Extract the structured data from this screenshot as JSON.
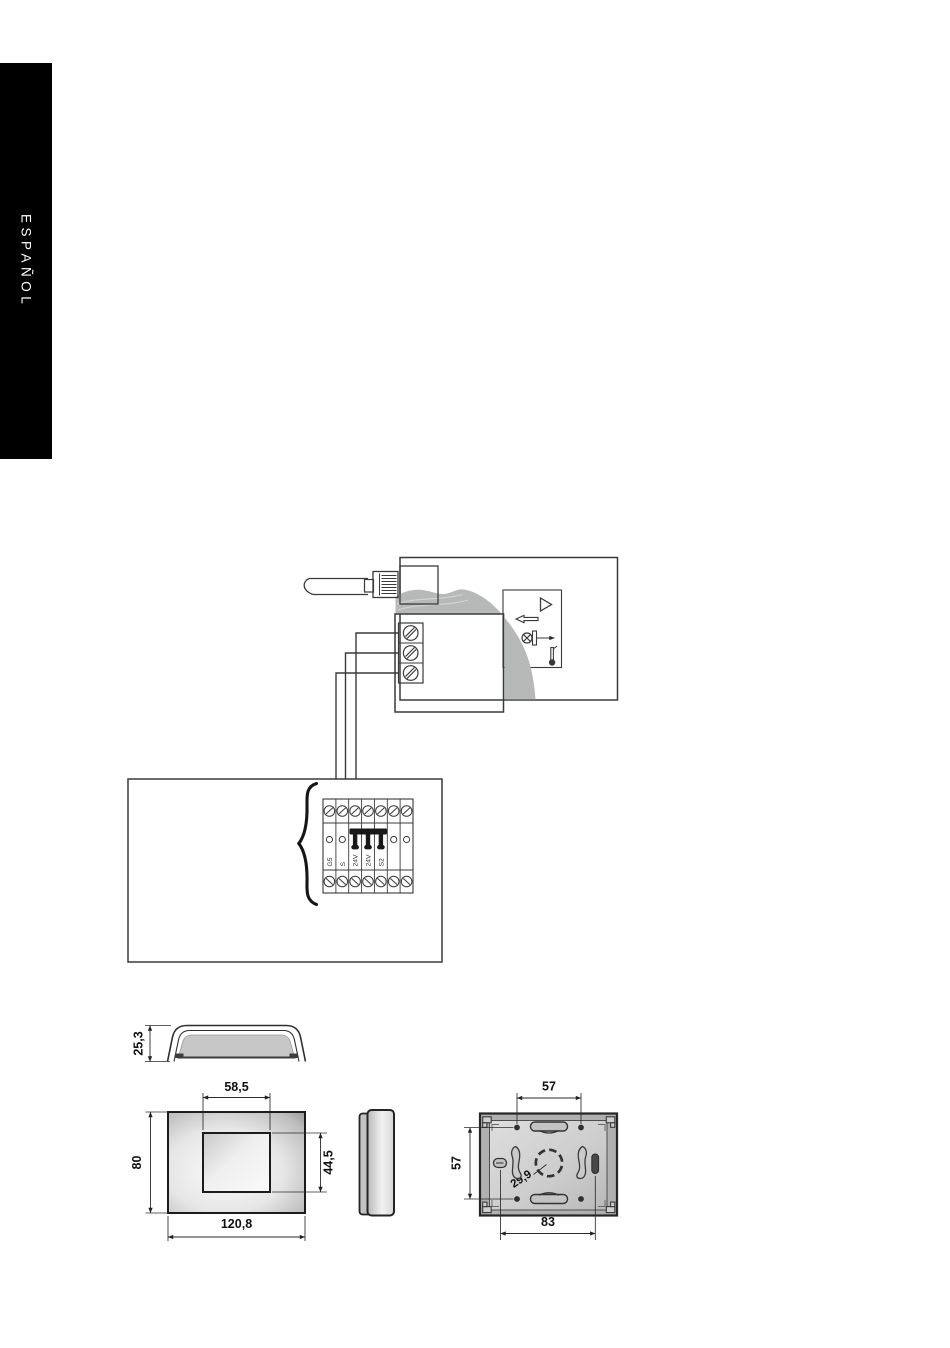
{
  "sidebar": {
    "language_label": "ESPAÑOL"
  },
  "wiring": {
    "unit_terminal_labels": [
      "G5",
      "S",
      "24V",
      "24V",
      "S2"
    ],
    "icons": [
      "rj-plug-icon",
      "screw-icon",
      "triangle-icon",
      "screwdriver-icon",
      "valve-icon",
      "thermometer-icon",
      "jumper-icon",
      "brace"
    ]
  },
  "dimensions": {
    "top_view_height": "25,3",
    "display_width": "58,5",
    "front_height": "80",
    "display_height": "44,5",
    "front_width": "120,8",
    "mount_hole_spacing_h": "57",
    "mount_hole_spacing_v": "57",
    "center_hole": "29,9",
    "slot_spacing": "83"
  },
  "colors": {
    "page_bg": "#ffffff",
    "tab_bg": "#000000",
    "tab_text": "#ffffff",
    "line": "#3a3a3a",
    "cable_gray": "#b6b9b8"
  }
}
